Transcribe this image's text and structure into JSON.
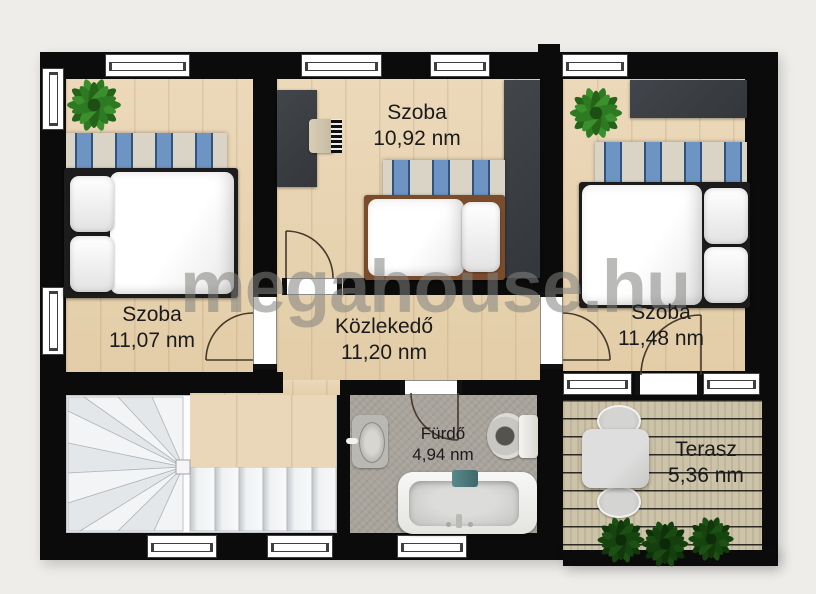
{
  "watermark": "megahouse.hu",
  "rooms": {
    "bedroom_left": {
      "name": "Szoba",
      "area": "11,07 nm"
    },
    "bedroom_middle": {
      "name": "Szoba",
      "area": "10,92 nm"
    },
    "bedroom_right": {
      "name": "Szoba",
      "area": "11,48 nm"
    },
    "hallway": {
      "name": "Közlekedő",
      "area": "11,20 nm"
    },
    "bathroom": {
      "name": "Fürdő",
      "area": "4,94 nm"
    },
    "terrace": {
      "name": "Terasz",
      "area": "5,36 nm"
    }
  },
  "colors": {
    "wall": "#0b0b0b",
    "wood_floor": "#e7d2b0",
    "terrace_deck": "#cdc3a9",
    "bathroom_floor": "#a8a49c",
    "rug_blue": "#6e94c4",
    "rug_cream": "#d9d4c5",
    "plant_green": "#2e7a22",
    "dark_furniture": "#3a3d42",
    "bed_frame_brown": "#7b4c2b",
    "towel_teal": "#4e7d80",
    "label_text": "#1b1b1b"
  }
}
